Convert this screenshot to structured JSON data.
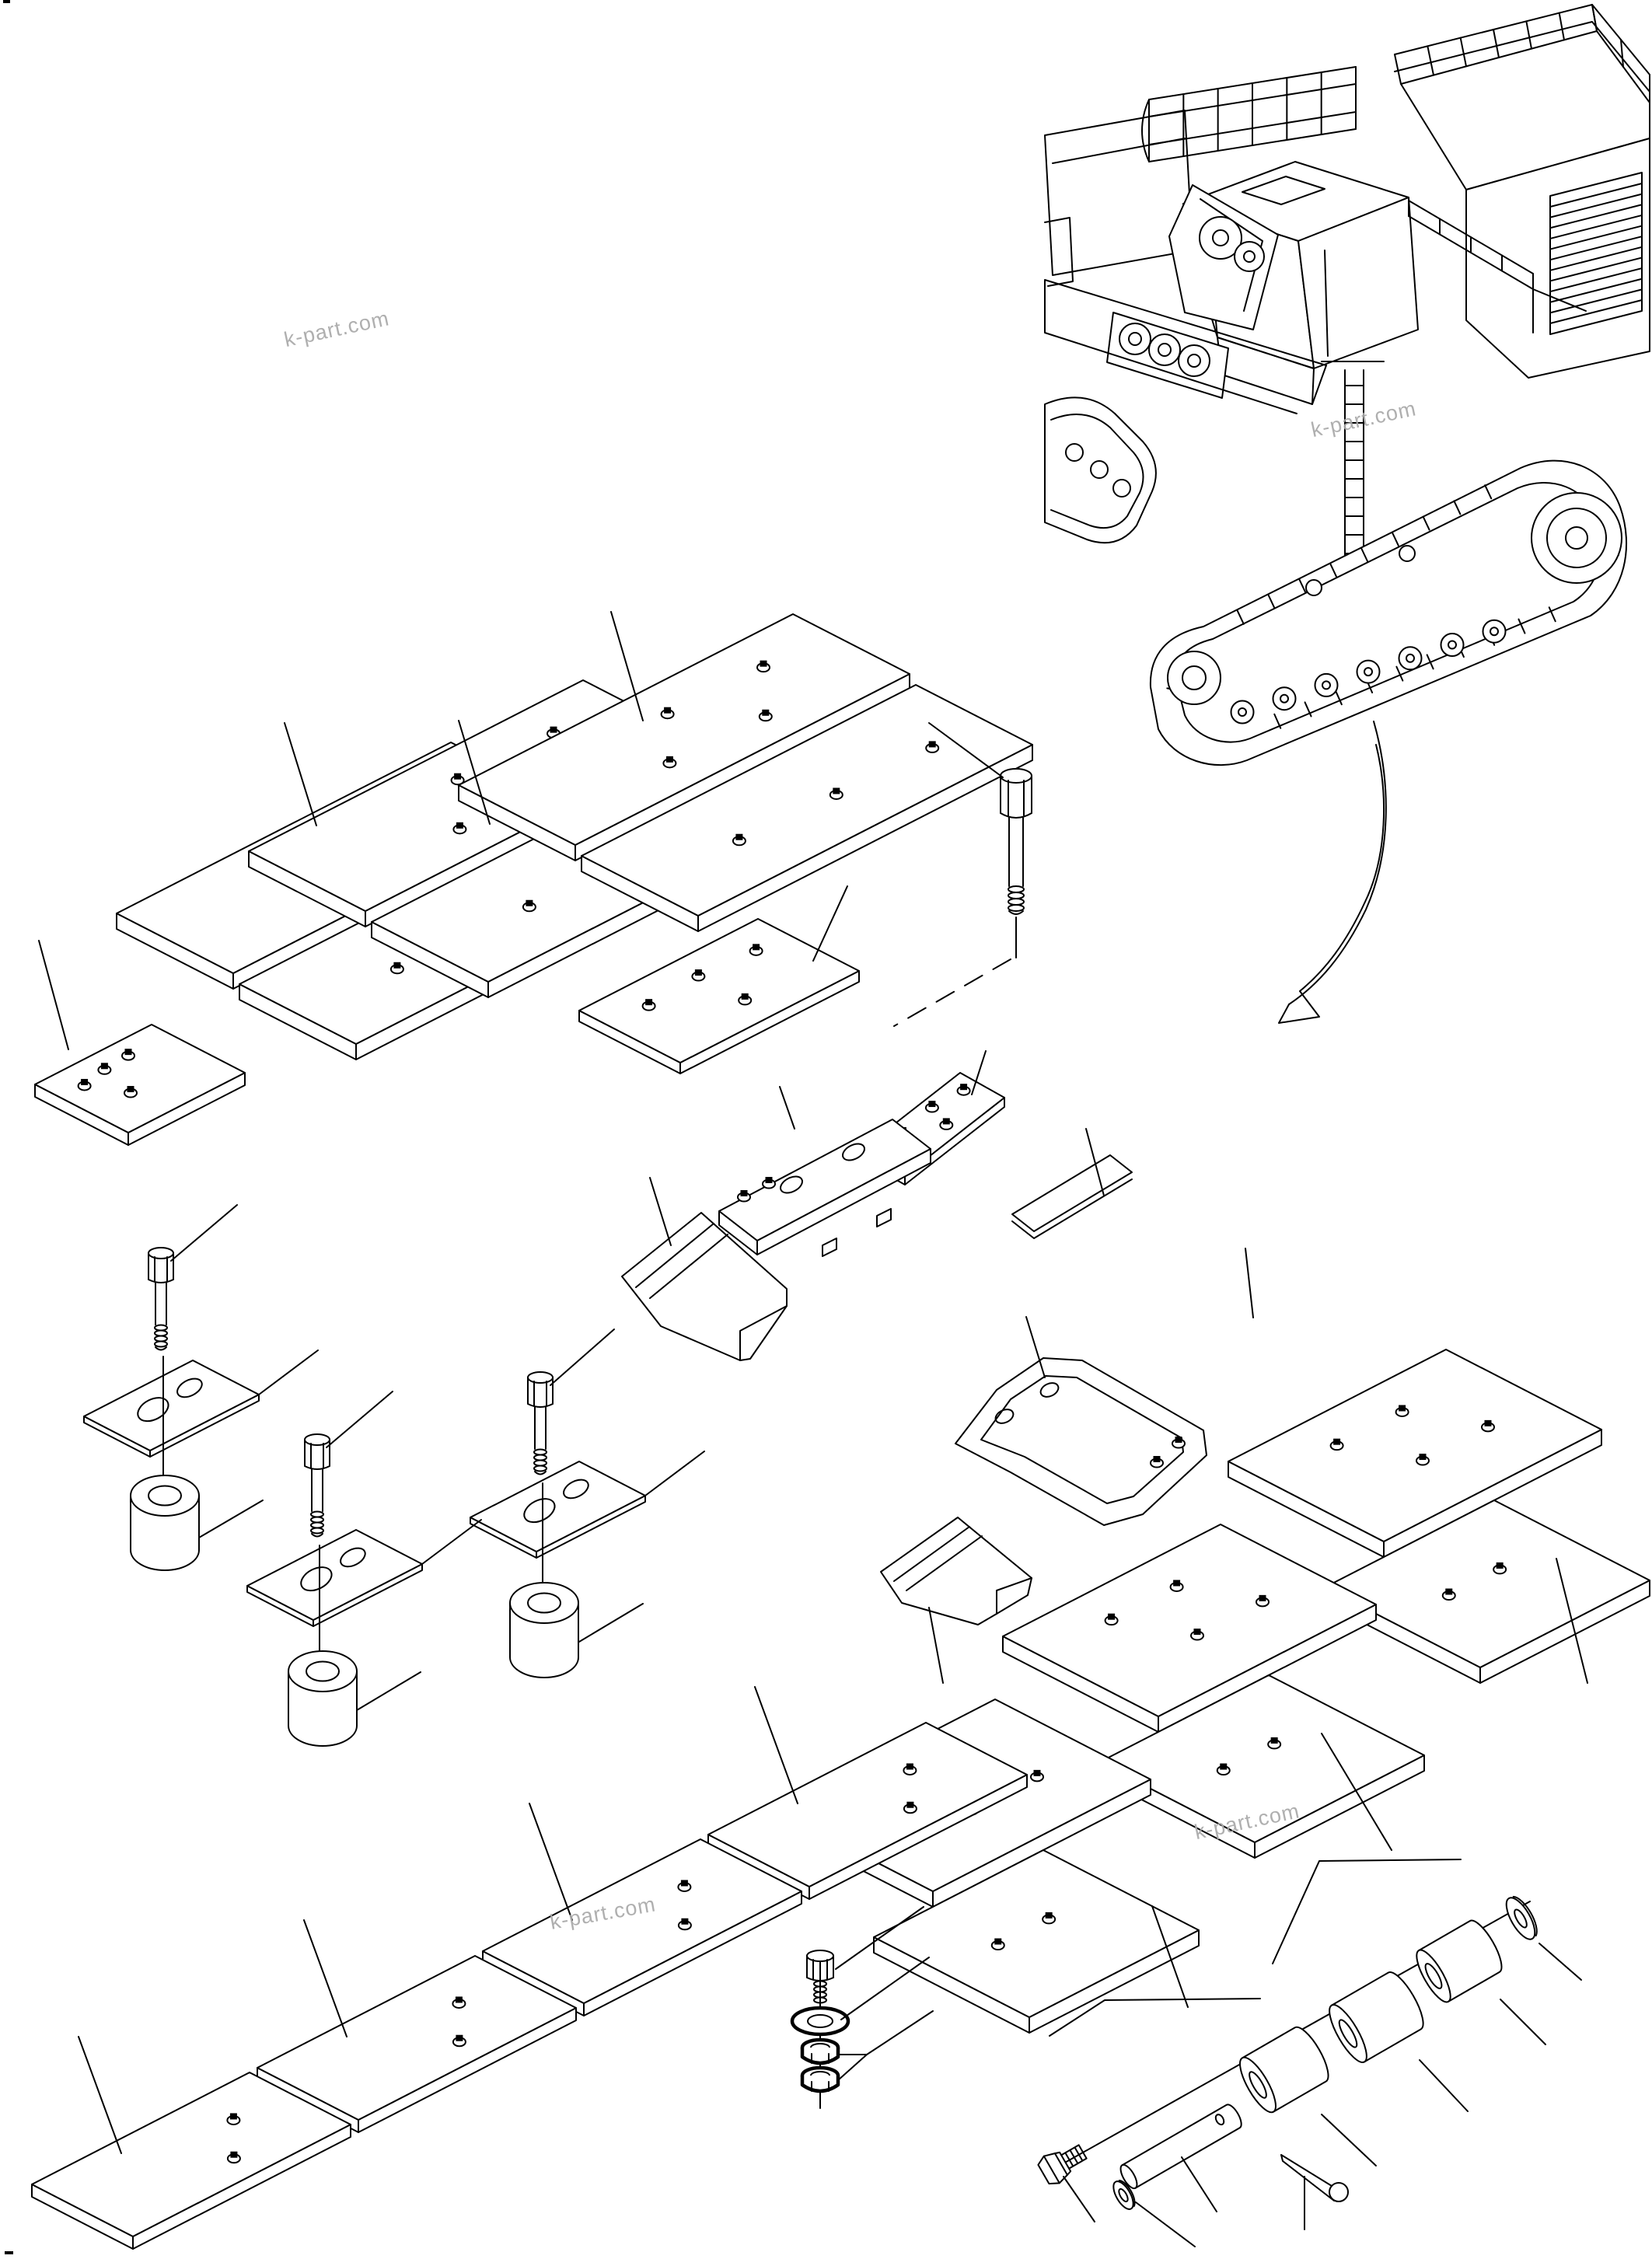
{
  "document": {
    "kind": "exploded-parts-diagram",
    "background_color": "#ffffff",
    "line_color": "#000000"
  },
  "watermark": {
    "text": "k-part.com",
    "color": "#a9a9a9"
  },
  "watermarks": [
    {
      "text": "k-part.com"
    },
    {
      "text": "k-part.com"
    },
    {
      "text": "k-part.com"
    },
    {
      "text": "k-part.com"
    }
  ]
}
